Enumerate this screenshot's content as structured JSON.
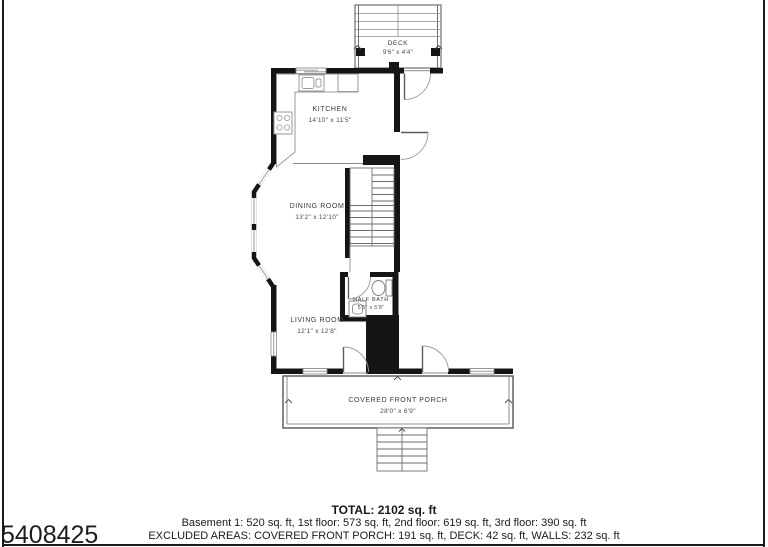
{
  "listing_id": "5408425",
  "rooms": {
    "deck": {
      "name": "DECK",
      "dims": "9'6\" x 4'4\""
    },
    "kitchen": {
      "name": "KITCHEN",
      "dims": "14'10\" x 11'5\""
    },
    "dining": {
      "name": "DINING ROOM",
      "dims": "13'2\" x 12'10\""
    },
    "half_bath": {
      "name": "HALF BATH",
      "dims": "5'5\" x 5'8\""
    },
    "living": {
      "name": "LIVING ROOM",
      "dims": "12'1\" x 12'8\""
    },
    "porch": {
      "name": "COVERED FRONT PORCH",
      "dims": "28'0\" x 6'9\""
    }
  },
  "summary": {
    "total": "TOTAL: 2102 sq. ft",
    "floors": "Basement 1: 520 sq. ft, 1st floor: 573 sq. ft, 2nd floor: 619 sq. ft, 3rd floor: 390 sq. ft",
    "excluded": "EXCLUDED AREAS: COVERED FRONT PORCH: 191 sq. ft, DECK: 42 sq. ft, WALLS: 232 sq. ft"
  },
  "colors": {
    "wall": "#151515",
    "thin_line": "#6e6e6e",
    "fixture": "#9a9a9a",
    "label": "#3a3a3a",
    "frame": "#1a1a1a"
  }
}
